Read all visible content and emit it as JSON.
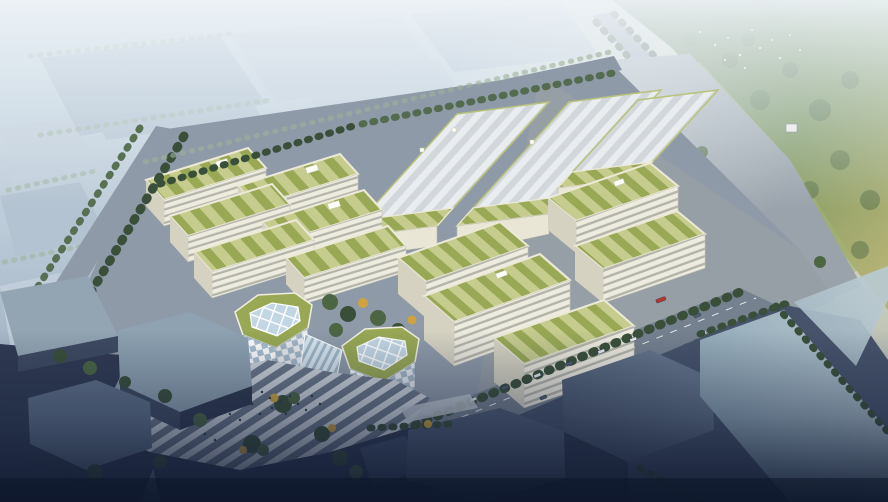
{
  "scene": {
    "type": "architectural-aerial-rendering",
    "description": "High oblique aerial rendering of an eco industrial park: rows of office buildings with striped green planted roofs, three striped-roof warehouse halls, two hexagonal pavilions with gridded glass skylights joined by a glass atrium, striped pedestrian plaza, tree-lined roads, hazy warehouse district behind, sunlit forest at upper right with a flock of birds, dark industrial blocks in the foreground",
    "lighting": "hazy daylight with warm glow from the upper right, dark vignette at the bottom",
    "inventory": {
      "left_office_cluster_buildings": 6,
      "warehouse_halls": 3,
      "south_row_buildings": 3,
      "east_row_buildings": 2,
      "hex_pavilions": 2,
      "atrium_links": 1,
      "plaza_tree_islands": 3,
      "flagpoles": 3,
      "birds": 12,
      "cars_and_trucks": 18,
      "pedestrians": 16
    }
  },
  "palette": {
    "sky_top": "#cfdce6",
    "sky_mid": "#bccbd8",
    "sky_low": "#9fb0c1",
    "sky_deep": "#6c7d95",
    "warm_glow": "#e9da9d",
    "haze_white": "#eef3f7",
    "bg_roof": "#b4c3d1",
    "bg_roof_light": "#c3cfdb",
    "bg_tree": "#9fb29b",
    "forest_dark": "#5d7850",
    "forest_mid": "#7e9862",
    "forest_warm": "#b3b275",
    "meadow": "#a4b474",
    "road_grey": "#8f9aa9",
    "road_warm": "#9aa3ab",
    "road_mid": "#75818f",
    "road_dark": "#46536b",
    "road_darker": "#2f3a52",
    "hedge_dark": "#3a4f3a",
    "hedge_mid": "#4c6644",
    "tree_autumn": "#cfa43d",
    "green_roof_a": "#c6cc8e",
    "green_roof_b": "#98a855",
    "roof_edge": "#ece9d8",
    "facade": "#eeebdf",
    "facade_band": "#b4b5aa",
    "facade_side": "#d5d2c2",
    "wh_roof_a": "#d2d7dc",
    "wh_roof_b": "#e9edf0",
    "wh_facade": "#e9e6d6",
    "glass": "#c2d6e3",
    "glass_dark": "#9fb8c8",
    "checker_blue": "#a9bfcf",
    "plaza_stripe": "#cfd6dd",
    "plaza_base": "#6a7688",
    "dark_top": "#64748b",
    "dark_top2": "#4e5c74",
    "dark_side": "#3d4a61",
    "dark_side2": "#2e394f",
    "pale_top": "#b9cad2",
    "pale_side": "#7e93a4",
    "car_white": "#e8ecef",
    "car_dark": "#4e5d6e",
    "car_red": "#b83630",
    "people": "#2e3a49",
    "vignette": "#15203a"
  }
}
